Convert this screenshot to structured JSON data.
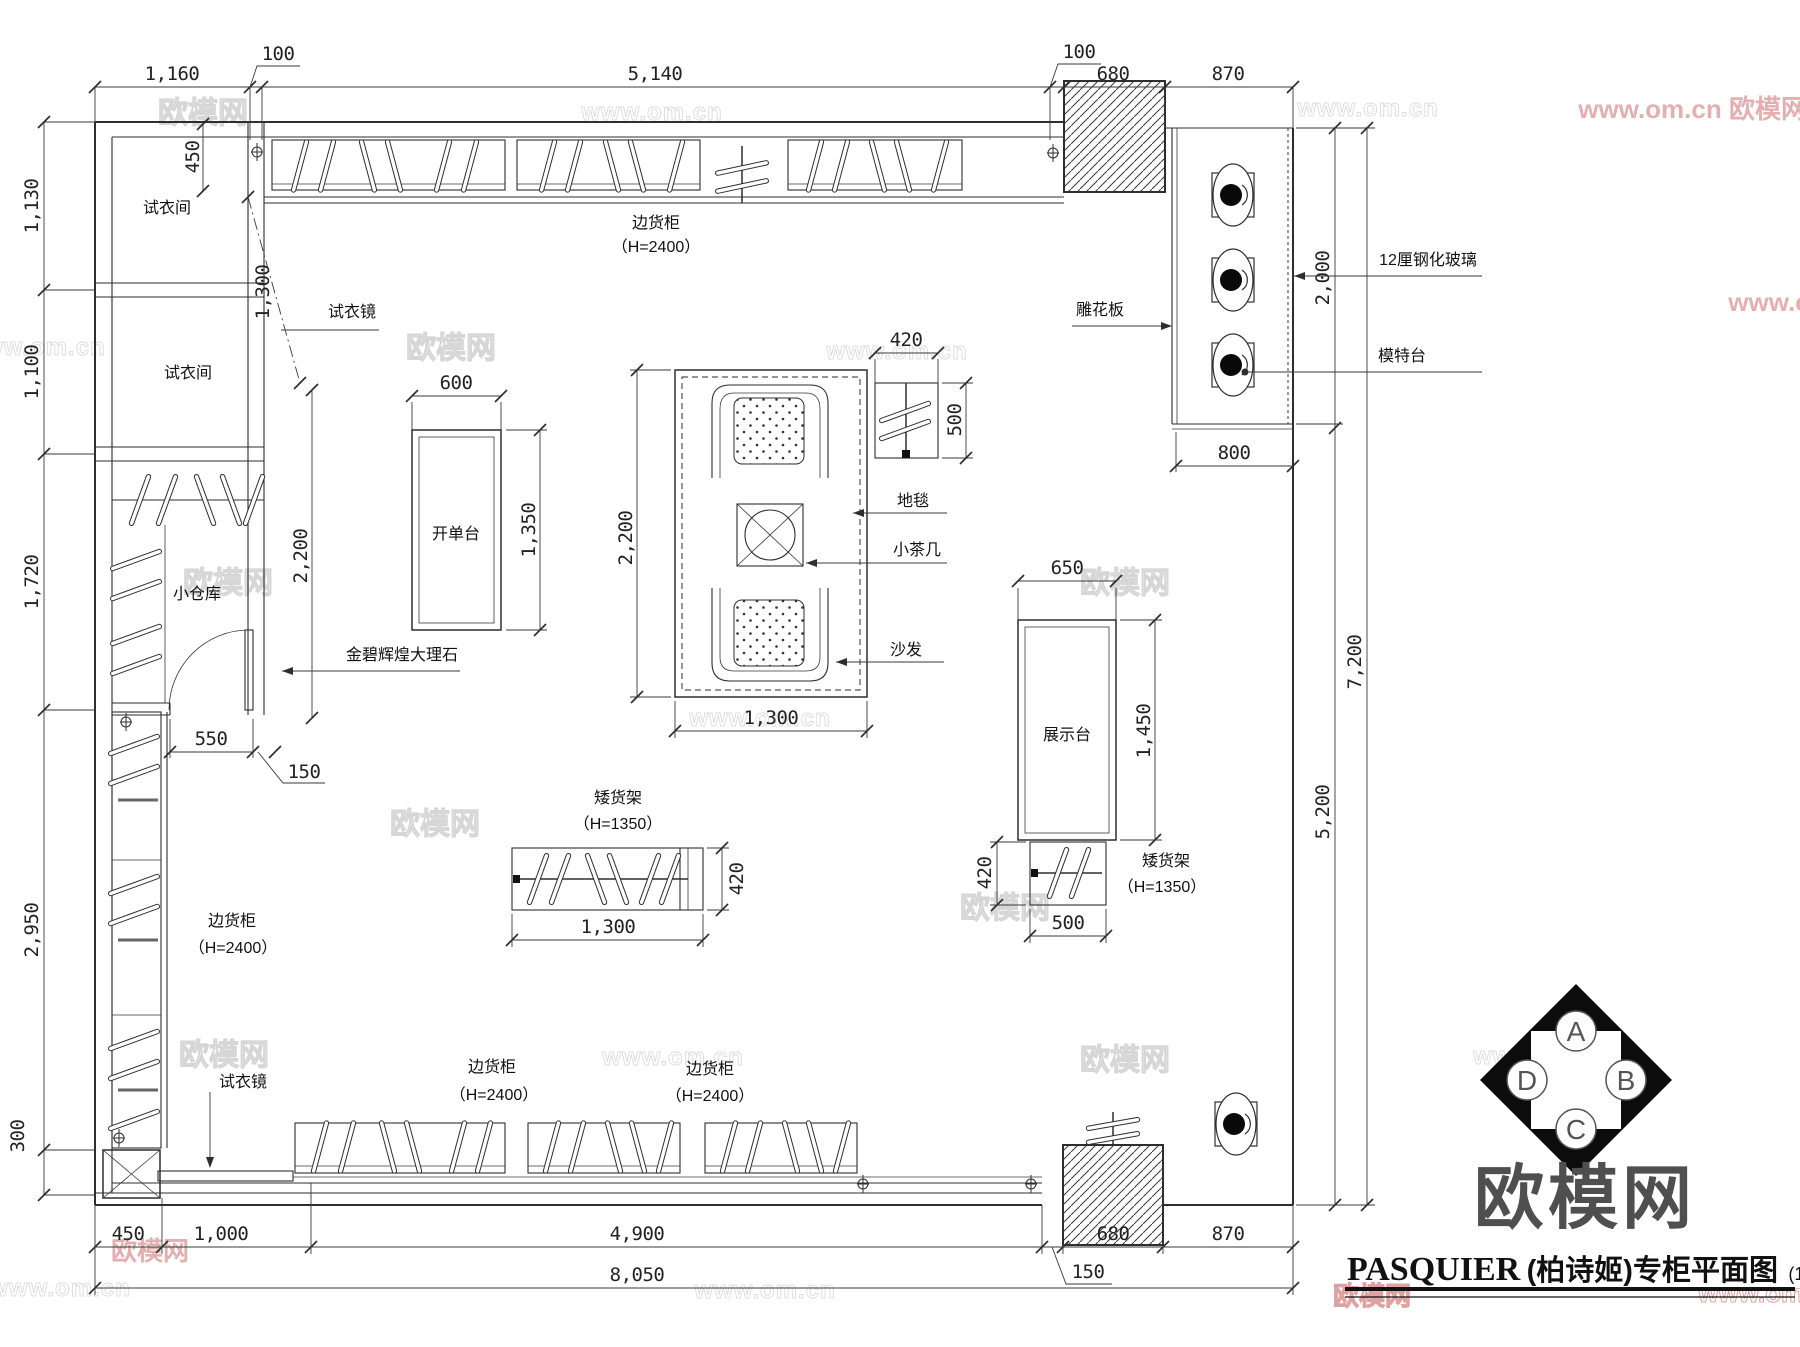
{
  "watermark": {
    "site": "欧模网",
    "url": "www.om.cn"
  },
  "compass": {
    "top": "A",
    "right": "B",
    "bottom": "C",
    "left": "D"
  },
  "title": {
    "logo": "欧模网",
    "brand": "PASQUIER",
    "name": "(柏诗姬)专柜平面图",
    "scale": "(1:50)"
  },
  "labels": {
    "fitting_room": "试衣间",
    "fitting_mirror": "试衣镜",
    "small_storage": "小仓库",
    "side_cabinet": "边货柜",
    "side_cabinet_height": "（H=2400）",
    "order_desk": "开单台",
    "marble": "金碧辉煌大理石",
    "carpet": "地毯",
    "tea_table": "小茶几",
    "sofa": "沙发",
    "display_stand": "展示台",
    "low_shelf": "矮货架",
    "low_shelf_height": "（H=1350）",
    "carved_panel": "雕花板",
    "tempered_glass": "12厘钢化玻璃",
    "model_stand": "模特台"
  },
  "dims": {
    "d100": "100",
    "d150": "150",
    "d300": "300",
    "d420": "420",
    "d450": "450",
    "d500": "500",
    "d550": "550",
    "d600": "600",
    "d650": "650",
    "d680": "680",
    "d800": "800",
    "d870": "870",
    "d1000": "1,000",
    "d1100": "1,100",
    "d1130": "1,130",
    "d1160": "1,160",
    "d1300": "1,300",
    "d1350": "1,350",
    "d1450": "1,450",
    "d1720": "1,720",
    "d2000": "2,000",
    "d2200": "2,200",
    "d2950": "2,950",
    "d4900": "4,900",
    "d5140": "5,140",
    "d5200": "5,200",
    "d7200": "7,200",
    "d8050": "8,050"
  }
}
